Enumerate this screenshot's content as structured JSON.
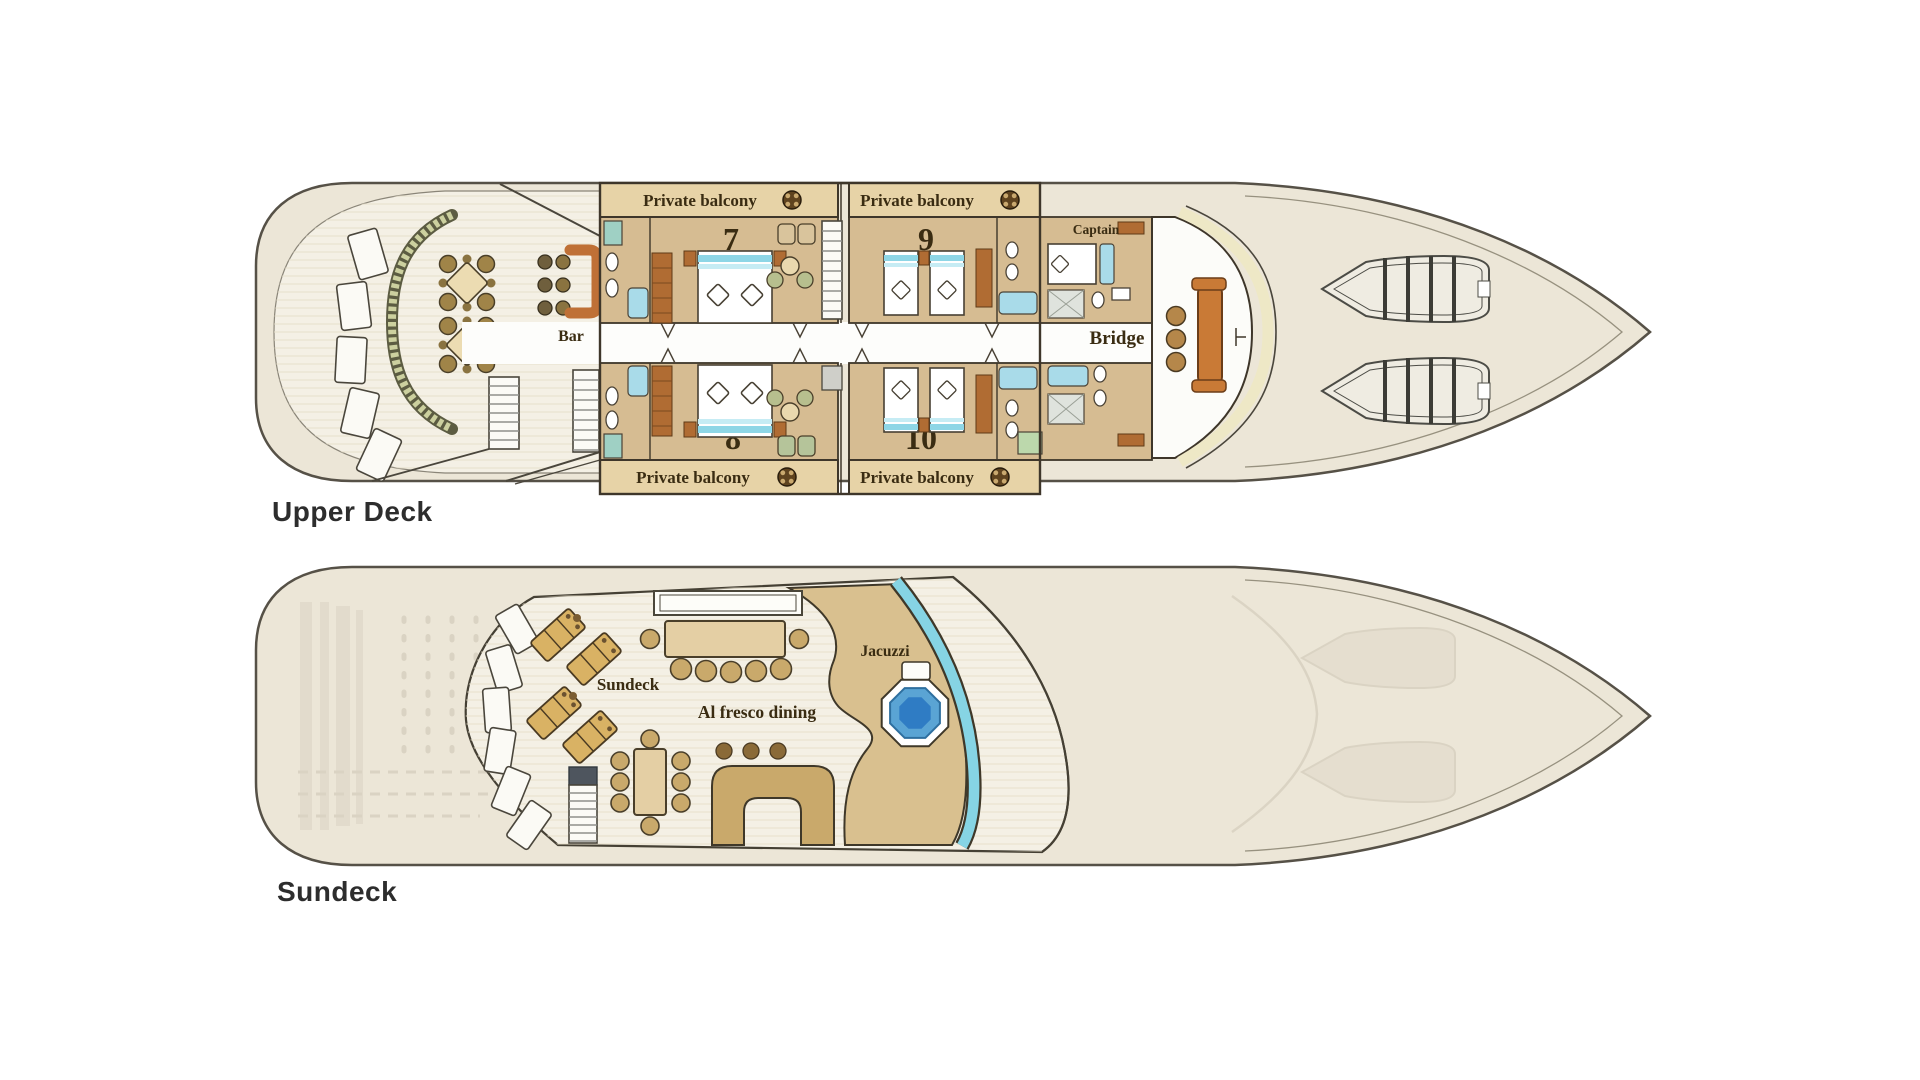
{
  "figure": {
    "kind": "yacht deck plan, two decks in profile-top view"
  },
  "upper_deck": {
    "caption": "Upper Deck",
    "balcony_front_left": "Private balcony",
    "balcony_front_right": "Private balcony",
    "balcony_rear_left": "Private balcony",
    "balcony_rear_right": "Private balcony",
    "cabin_7": "7",
    "cabin_9": "9",
    "cabin_8": "8",
    "cabin_10": "10",
    "bar": "Bar",
    "captain": "Captain",
    "bridge": "Bridge"
  },
  "sundeck": {
    "caption": "Sundeck",
    "area": "Sundeck",
    "dining": "Al fresco dining",
    "jacuzzi": "Jacuzzi"
  },
  "colors": {
    "background": "#ffffff",
    "hull_fill": "#ece6d7",
    "hull_outline": "#565147",
    "deck_floor": "#f4f0e5",
    "cabin_floor": "#d6bc92",
    "balcony_strip": "#e7d3a7",
    "wall": "#3e362a",
    "wood": "#b06c33",
    "bar_counter": "#bf7036",
    "aqua_band": "#8ed6e6",
    "fixture_cyan": "#a9dbe9",
    "table_tan": "#e9d8ae",
    "chair_tan": "#c9a96b",
    "lounger_tan": "#d9b264",
    "jacuzzi_blue": "#5aa4d4",
    "jacuzzi_deep": "#2f7cc4",
    "glass_cyan": "#86d4e4",
    "sun_area_tan": "#d9c08f",
    "label_brown": "#3a2c12",
    "caption_gray": "#2d2d2d",
    "fan_brown": "#5f431f",
    "ghost": "#b7ae9c"
  }
}
